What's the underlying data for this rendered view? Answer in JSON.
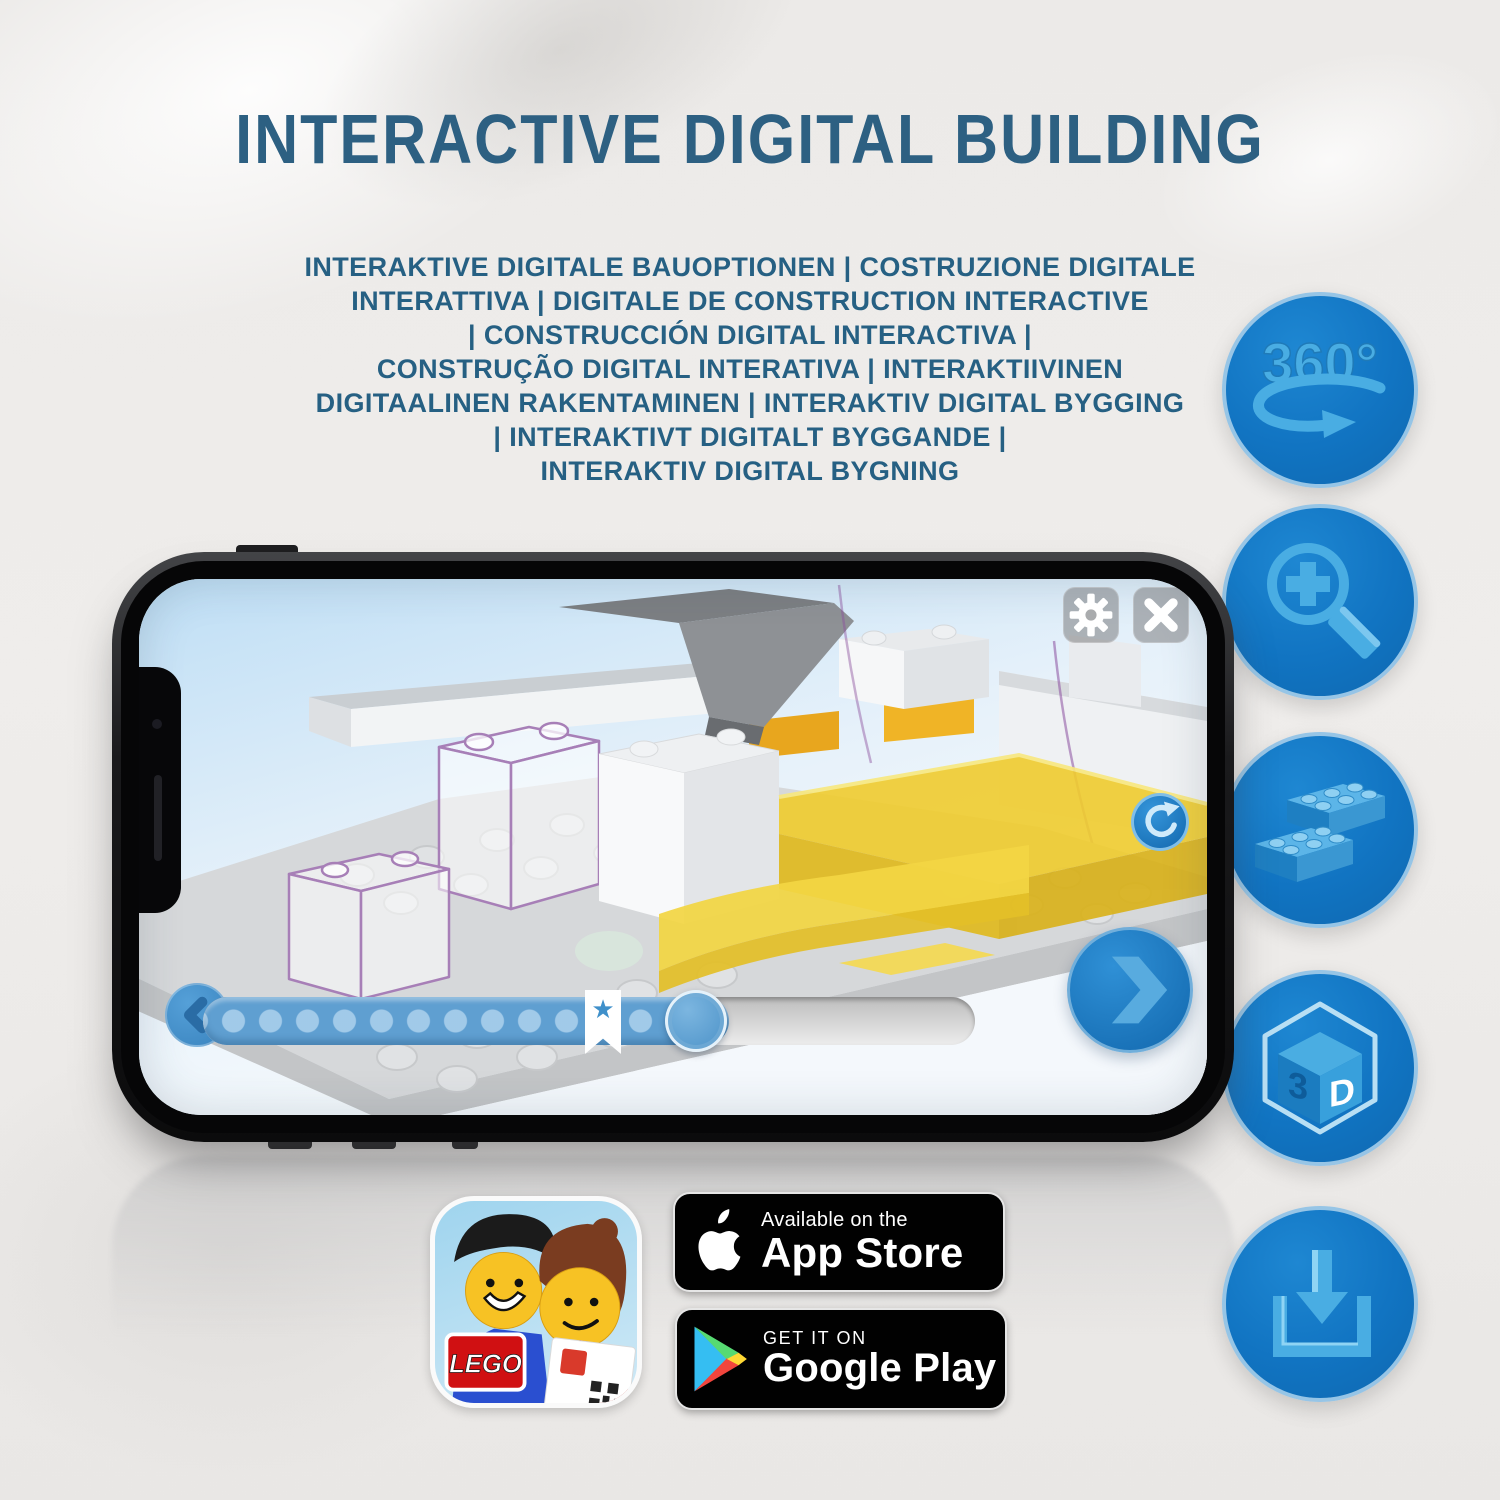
{
  "header": {
    "title": "INTERACTIVE DIGITAL BUILDING",
    "subtitle_lines": [
      "INTERAKTIVE DIGITALE BAUOPTIONEN | COSTRUZIONE DIGITALE",
      "INTERATTIVA | DIGITALE DE CONSTRUCTION INTERACTIVE",
      "| CONSTRUCCIÓN DIGITAL INTERACTIVA |",
      "CONSTRUÇÃO DIGITAL INTERATIVA | INTERAKTIIVINEN",
      "DIGITAALINEN RAKENTAMINEN | INTERAKTIV DIGITAL BYGGING",
      "| INTERAKTIVT DIGITALT BYGGANDE |",
      "INTERAKTIV DIGITAL BYGNING"
    ]
  },
  "features": {
    "items": [
      "360-rotation",
      "zoom-in",
      "brick-options",
      "3d-view",
      "download"
    ],
    "rotate_360_label": "360°",
    "cube_left_face": "3",
    "cube_right_face": "D"
  },
  "phone_app": {
    "toolbar_icons": [
      "settings-gear",
      "close-x"
    ],
    "controls": [
      "rotate-reset",
      "previous-step",
      "next-step",
      "progress-slider"
    ],
    "progress": {
      "star_glyph": "★"
    }
  },
  "store_badges": {
    "app_store": {
      "line1": "Available on the",
      "line2": "App Store"
    },
    "google_play": {
      "line1": "GET IT ON",
      "line2": "Google Play"
    }
  },
  "lego_app_icon": {
    "logo_text": "LEGO"
  },
  "colors": {
    "title_blue": "#2d6082",
    "feature_circle_blue": "#1478c8",
    "feature_glyph_blue": "#49ade3",
    "app_ui_blue": "#2e86cc",
    "brick_yellow": "#f0cc2e",
    "badge_black": "#010101"
  }
}
